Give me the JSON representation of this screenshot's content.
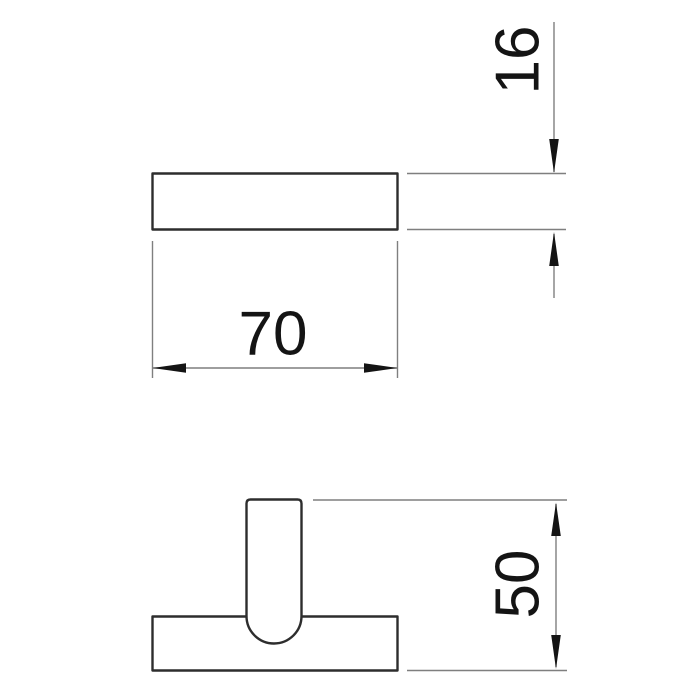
{
  "colors": {
    "background": "#ffffff",
    "outline": "#2d2d2d",
    "dimension": "#7f7f7f",
    "annotation": "#141414"
  },
  "drawing": {
    "kind": "technical-dimension-drawing",
    "dimensions": {
      "top_width": {
        "label": "70",
        "value": 70
      },
      "top_thickness": {
        "label": "16",
        "value": 16
      },
      "front_height": {
        "label": "50",
        "value": 50
      }
    }
  }
}
